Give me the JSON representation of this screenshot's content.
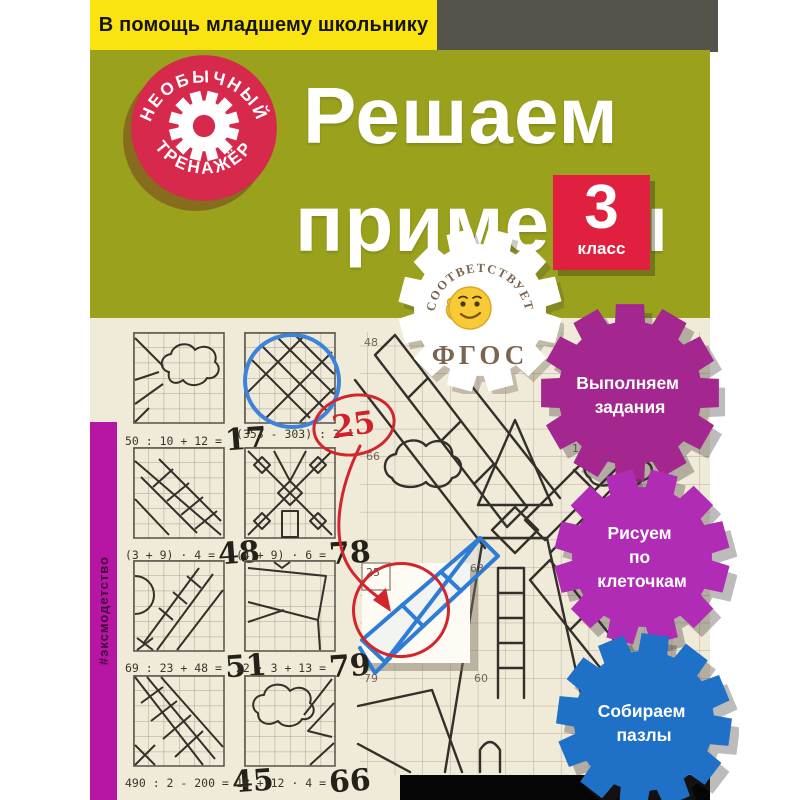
{
  "banner": {
    "text": "В помощь младшему школьнику"
  },
  "round_badge": {
    "arc_top": "НЕОБЫЧНЫЙ",
    "arc_bottom": "ТРЕНАЖЁР"
  },
  "title": {
    "line1": "Решаем",
    "line2": "примеры"
  },
  "grade_badge": {
    "number": "3",
    "label": "класс"
  },
  "fgos_badge": {
    "arc_top": "СООТВЕТСТВУЕТ",
    "label": "ФГОС"
  },
  "feature_badges": [
    {
      "lines": [
        "Выполняем",
        "задания"
      ],
      "color": "#a3278f"
    },
    {
      "lines": [
        "Рисуем",
        "по",
        "клеточкам"
      ],
      "color": "#b02cb5"
    },
    {
      "lines": [
        "Собираем",
        "пазлы"
      ],
      "color": "#1e71c6"
    }
  ],
  "spine": {
    "hashtag": "#эксмодетство"
  },
  "exercises": [
    {
      "expression": "50 : 10 + 12 =",
      "answer": "17"
    },
    {
      "expression": "(353 - 303) : 2 =",
      "answer": "25",
      "annotated": "red-circle"
    },
    {
      "expression": "(3 + 9) · 4 =",
      "answer": "48"
    },
    {
      "expression": "(4 + 9) · 6 =",
      "answer": "78"
    },
    {
      "expression": "69 : 23 + 48 =",
      "answer": "51"
    },
    {
      "expression": "22 · 3 + 13 =",
      "answer": "79"
    },
    {
      "expression": "490 : 2 - 200 =",
      "answer": "45"
    },
    {
      "expression": "18 + 12 · 4 =",
      "answer": "66"
    }
  ],
  "grid_numbers": [
    "48",
    "66",
    "25",
    "63",
    "79",
    "60",
    "17"
  ],
  "colors": {
    "olive_bg": "#9aa11d",
    "banner_yellow": "#f9e311",
    "badge_red": "#d7294b",
    "grade_red": "#e11f3e",
    "spine_magenta": "#b716a5",
    "gear_purple": "#a3278f",
    "gear_violet": "#b02cb5",
    "gear_blue": "#1e71c6",
    "pen_red": "#d2252c",
    "pen_blue": "#3c83da",
    "paper": "#f0ead9"
  }
}
